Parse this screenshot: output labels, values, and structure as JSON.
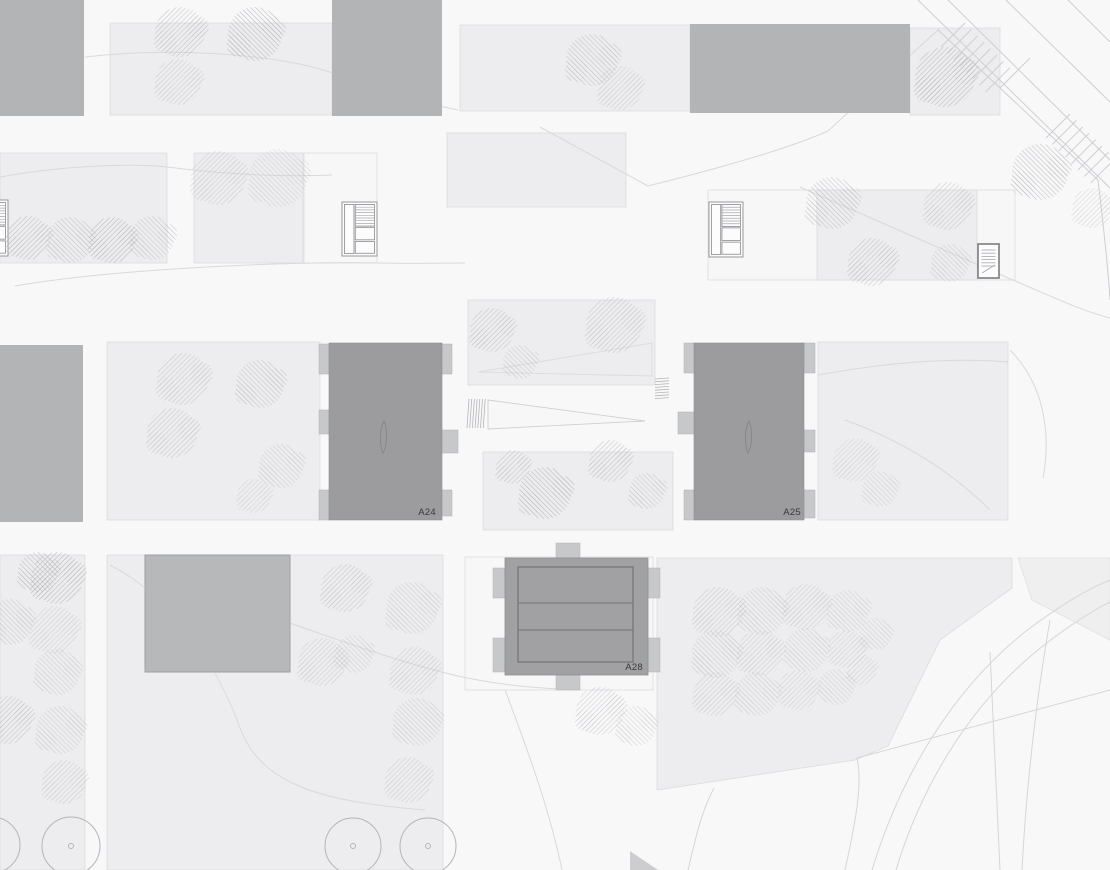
{
  "plan": {
    "canvas": {
      "width": 1110,
      "height": 870
    },
    "labels": {
      "a24": "A24",
      "a25": "A25",
      "a28": "A28"
    },
    "colors": {
      "background": "#f8f8f9",
      "plot_fill": "#ededef",
      "plot_stroke": "#dcdcdf",
      "white_plot_fill": "#f7f7f8",
      "block_fill": "#b3b4b6",
      "tower_fill": "#9c9c9e",
      "tower_stroke": "#8f8f92",
      "tab_fill": "#c7c8ca",
      "tab_stroke": "#b2b2b5",
      "a28_fill": "#a1a1a3",
      "a28_inner_stroke": "#737377",
      "building_fill": "#b7b8b9",
      "building_stroke": "#a0a0a3",
      "tree_hatch": "#bcbcc1",
      "contour": "#d9d9dc",
      "road": "#cfcfd3",
      "curve": "#d6d6da",
      "circle_tree": "#b5b5b9",
      "label": "#39393d",
      "stair_stroke": "#97979b",
      "stair_tread": "#a8a8ac",
      "lens_stroke": "#87878b",
      "triangle_fill": "#c6c6c9"
    },
    "plots": [
      [
        110,
        23,
        222,
        92,
        0
      ],
      [
        460,
        25,
        230,
        86,
        0
      ],
      [
        447,
        133,
        179,
        74,
        0
      ],
      [
        0,
        153,
        167,
        110,
        0
      ],
      [
        194,
        153,
        109,
        110,
        0
      ],
      [
        304,
        153,
        73,
        110,
        1
      ],
      [
        708,
        190,
        307,
        90,
        1
      ],
      [
        817,
        190,
        160,
        90,
        0
      ],
      [
        910,
        28,
        90,
        87,
        0
      ],
      [
        107,
        342,
        213,
        178,
        0
      ],
      [
        468,
        300,
        187,
        85,
        0
      ],
      [
        483,
        452,
        190,
        78,
        0
      ],
      [
        818,
        342,
        190,
        178,
        0
      ],
      [
        0,
        555,
        85,
        315,
        0
      ],
      [
        107,
        555,
        336,
        315,
        0
      ],
      [
        465,
        557,
        188,
        133,
        1
      ]
    ],
    "orchard_polygon": "657,558 1012,558 1012,588 940,640 888,746 855,760 657,790",
    "right_wedge_polygon": "1018,558 1110,558 1110,640 1032,600",
    "blocks": [
      [
        0,
        0,
        84,
        116
      ],
      [
        332,
        0,
        110,
        116
      ],
      [
        690,
        24,
        220,
        89
      ],
      [
        0,
        345,
        83,
        177
      ]
    ],
    "building_rect": [
      145,
      555,
      145,
      117
    ],
    "towers": [
      {
        "label_key": "a24",
        "rect": [
          329,
          343,
          113,
          177
        ],
        "tabs": [
          [
            319,
            344,
            10,
            30
          ],
          [
            319,
            410,
            10,
            24
          ],
          [
            319,
            490,
            10,
            30
          ],
          [
            442,
            344,
            10,
            30
          ],
          [
            442,
            430,
            16,
            23
          ],
          [
            442,
            490,
            10,
            26
          ]
        ],
        "lens": [
          384,
          437
        ],
        "label_pos": [
          436,
          515
        ]
      },
      {
        "label_key": "a25",
        "rect": [
          694,
          343,
          110,
          177
        ],
        "tabs": [
          [
            684,
            343,
            10,
            30
          ],
          [
            678,
            412,
            16,
            22
          ],
          [
            684,
            490,
            10,
            30
          ],
          [
            804,
            343,
            11,
            30
          ],
          [
            804,
            430,
            11,
            22
          ],
          [
            804,
            490,
            11,
            28
          ]
        ],
        "lens": [
          749,
          437
        ],
        "label_pos": [
          801,
          515
        ]
      }
    ],
    "a28": {
      "label_key": "a28",
      "outer": [
        505,
        558,
        143,
        117
      ],
      "inner": [
        518,
        567,
        115,
        95
      ],
      "dividers": [
        603,
        630
      ],
      "tabs": [
        [
          556,
          543,
          24,
          15
        ],
        [
          556,
          675,
          24,
          15
        ],
        [
          493,
          568,
          12,
          30
        ],
        [
          493,
          638,
          12,
          34
        ],
        [
          648,
          568,
          12,
          30
        ],
        [
          648,
          638,
          12,
          34
        ]
      ],
      "label_pos": [
        643,
        670
      ]
    },
    "stairs": [
      [
        -26,
        200,
        34,
        56,
        "large"
      ],
      [
        342,
        202,
        35,
        54,
        "large"
      ],
      [
        709,
        202,
        34,
        55,
        "large"
      ],
      [
        978,
        244,
        21,
        34,
        "small"
      ]
    ],
    "trees": [
      [
        180,
        32,
        25,
        0,
        0.8
      ],
      [
        255,
        34,
        27,
        1,
        1
      ],
      [
        178,
        82,
        23,
        0,
        0.6
      ],
      [
        592,
        60,
        26,
        1,
        0.8
      ],
      [
        620,
        88,
        22,
        0,
        0.6
      ],
      [
        945,
        77,
        30,
        0,
        1
      ],
      [
        1040,
        172,
        28,
        1,
        0.9
      ],
      [
        1092,
        208,
        20,
        0,
        0.5
      ],
      [
        28,
        238,
        22,
        0,
        0.9
      ],
      [
        70,
        240,
        23,
        1,
        0.8
      ],
      [
        112,
        240,
        23,
        0,
        1
      ],
      [
        152,
        238,
        22,
        1,
        0.7
      ],
      [
        218,
        178,
        27,
        0,
        0.6
      ],
      [
        278,
        178,
        29,
        1,
        0.5
      ],
      [
        832,
        203,
        26,
        1,
        0.8
      ],
      [
        948,
        206,
        24,
        0,
        0.7
      ],
      [
        872,
        262,
        24,
        0,
        0.8
      ],
      [
        950,
        263,
        19,
        1,
        0.6
      ],
      [
        183,
        379,
        26,
        0,
        0.7
      ],
      [
        260,
        384,
        24,
        1,
        0.8
      ],
      [
        172,
        433,
        25,
        0,
        0.7
      ],
      [
        281,
        466,
        22,
        1,
        0.6
      ],
      [
        254,
        496,
        17,
        0,
        0.5
      ],
      [
        492,
        330,
        22,
        0,
        0.8
      ],
      [
        520,
        362,
        17,
        1,
        0.6
      ],
      [
        614,
        325,
        28,
        0,
        0.7
      ],
      [
        513,
        467,
        17,
        0,
        0.8
      ],
      [
        545,
        493,
        26,
        1,
        1
      ],
      [
        610,
        461,
        21,
        0,
        0.8
      ],
      [
        647,
        491,
        18,
        1,
        0.7
      ],
      [
        855,
        460,
        22,
        0,
        0.5
      ],
      [
        880,
        489,
        18,
        1,
        0.5
      ],
      [
        38,
        572,
        20,
        1,
        0.9
      ],
      [
        57,
        578,
        26,
        0,
        1
      ],
      [
        10,
        622,
        23,
        1,
        0.7
      ],
      [
        54,
        630,
        24,
        0,
        0.55
      ],
      [
        57,
        672,
        23,
        1,
        0.6
      ],
      [
        8,
        720,
        24,
        0,
        0.8
      ],
      [
        60,
        730,
        24,
        1,
        0.6
      ],
      [
        64,
        782,
        22,
        0,
        0.6
      ],
      [
        345,
        588,
        24,
        0,
        0.7
      ],
      [
        412,
        608,
        26,
        1,
        0.6
      ],
      [
        322,
        662,
        24,
        0,
        0.6
      ],
      [
        354,
        654,
        19,
        1,
        0.55
      ],
      [
        414,
        671,
        24,
        0,
        0.6
      ],
      [
        417,
        722,
        24,
        1,
        0.6
      ],
      [
        408,
        780,
        23,
        0,
        0.55
      ],
      [
        600,
        711,
        24,
        0,
        0.7
      ],
      [
        636,
        726,
        20,
        1,
        0.6
      ],
      [
        718,
        612,
        25,
        0,
        0.65
      ],
      [
        762,
        611,
        24,
        1,
        0.6
      ],
      [
        806,
        607,
        23,
        0,
        0.6
      ],
      [
        848,
        611,
        21,
        1,
        0.55
      ],
      [
        716,
        654,
        24,
        1,
        0.65
      ],
      [
        760,
        653,
        23,
        0,
        0.6
      ],
      [
        806,
        650,
        22,
        1,
        0.55
      ],
      [
        847,
        649,
        19,
        0,
        0.5
      ],
      [
        876,
        634,
        16,
        1,
        0.5
      ],
      [
        715,
        694,
        22,
        0,
        0.6
      ],
      [
        757,
        694,
        22,
        1,
        0.55
      ],
      [
        798,
        690,
        20,
        0,
        0.5
      ],
      [
        836,
        687,
        18,
        1,
        0.5
      ],
      [
        862,
        670,
        15,
        0,
        0.45
      ]
    ],
    "circle_trees": [
      [
        -8,
        845,
        28
      ],
      [
        71,
        846,
        29
      ],
      [
        353,
        846,
        28
      ],
      [
        428,
        846,
        28
      ]
    ],
    "contours": [
      "M 85,57 C 180,46 290,56 335,74 C 388,94 428,104 458,110",
      "M 0,177 C 60,166 130,163 167,167 C 230,175 285,177 332,175",
      "M 15,286 C 120,268 300,261 380,263 C 420,264 445,263 465,263",
      "M 540,127 L 648,186",
      "M 648,186 C 720,168 790,148 828,131 L 940,28",
      "M 800,187 L 1015,281",
      "M 1015,281 C 1060,300 1080,310 1110,318",
      "M 110,565 C 175,598 220,672 240,728 C 262,788 330,802 425,810",
      "M 290,623 C 360,648 420,668 467,678 C 530,690 560,688 575,690",
      "M 505,690 C 530,756 550,812 562,870",
      "M 818,375 C 900,360 960,358 1008,362",
      "M 845,420 C 900,440 950,470 990,510",
      "M 1010,350 C 1042,382 1052,430 1043,478"
    ],
    "roads": [
      "M 918,0 L 1110,188",
      "M 948,0 L 1110,160",
      "M 1006,0 L 1110,102",
      "M 1068,0 L 1110,42",
      "M 938,30 L 1000,88 L 1048,133",
      "M 1000,88 L 1030,58",
      "M 1048,133 L 1098,180",
      "M 1098,180 C 1104,230 1108,268 1110,300"
    ],
    "ladders": [
      [
        941,
        47,
        8,
        6.4,
        24
      ],
      [
        1046,
        138,
        8,
        6.4,
        24
      ]
    ],
    "curves": [
      "M 872,870 C 900,778 952,688 1030,628 C 1068,600 1095,586 1110,580",
      "M 896,870 C 922,784 972,700 1048,642 C 1080,618 1100,607 1110,602",
      "M 845,870 C 858,812 862,780 857,758",
      "M 857,758 L 1110,690",
      "M 1050,620 C 1036,700 1026,790 1022,870",
      "M 990,652 L 1000,870",
      "M 688,870 C 696,836 702,810 714,788"
    ],
    "ramp": {
      "wedge": "478,372 652,343 652,376",
      "tri": "488,400 645,421 488,429",
      "stair_v": [
        469,
        399,
        7,
        2.7,
        29
      ],
      "stair_h": [
        655,
        379,
        8,
        2.8,
        14
      ]
    },
    "triangle": "630,851 658,870 630,870"
  }
}
